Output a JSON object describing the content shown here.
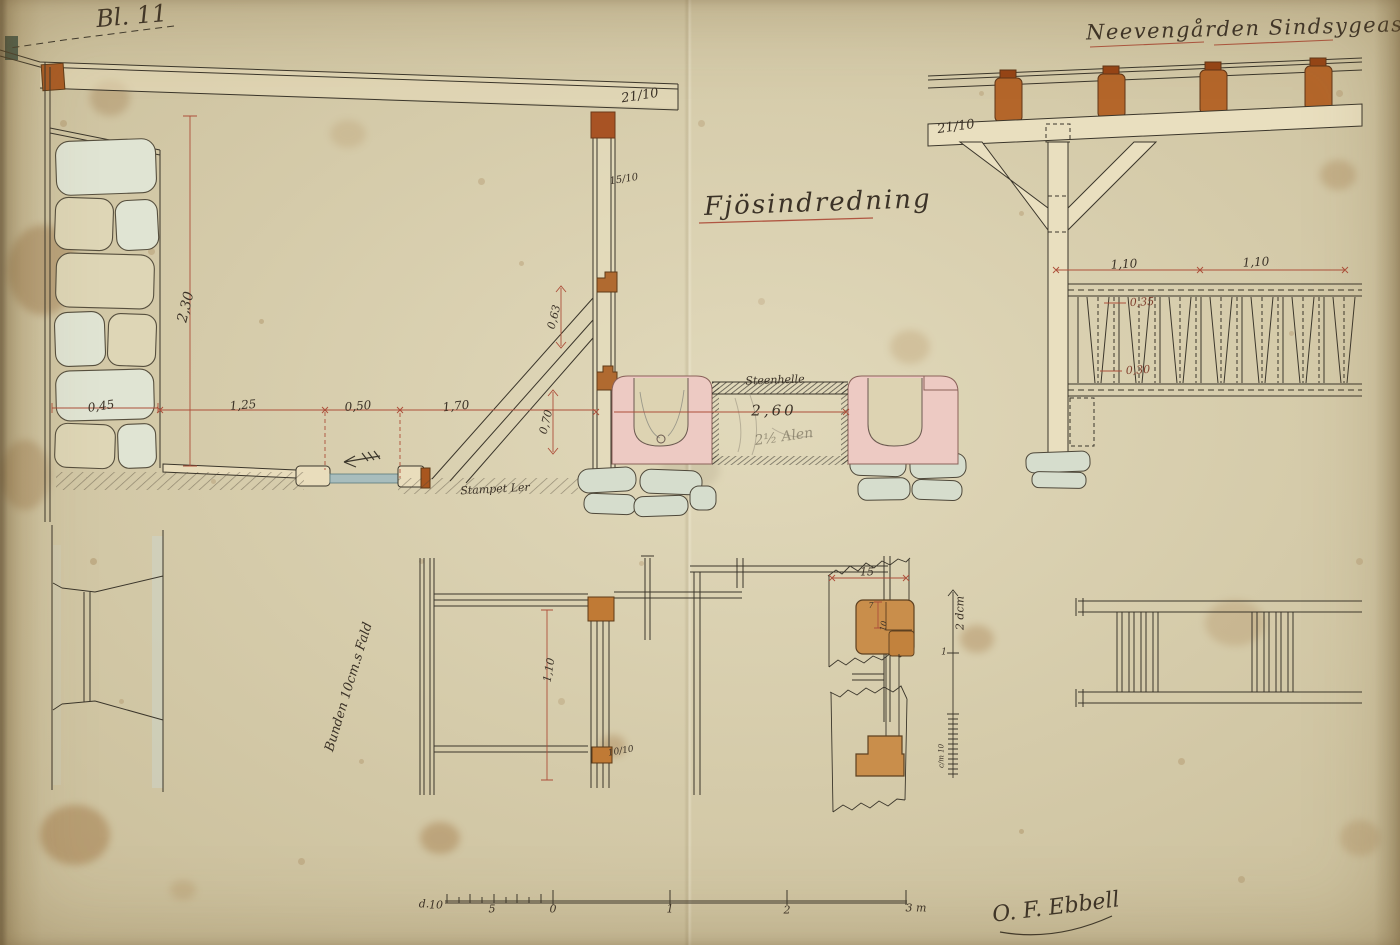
{
  "sheet": {
    "number": "Bl. 11"
  },
  "titles": {
    "project": "Neevengården Sindsygeasyl.",
    "drawing": "Fjösindredning"
  },
  "section": {
    "beam_dim": "21/10",
    "post_dim": "15/10",
    "wall_height": "2,30",
    "wall_thickness": "0,45",
    "span_left": "1,25",
    "span_mid": "0,50",
    "span_right": "1,70",
    "bracket_height": "0,63",
    "trough_height": "0,70",
    "stall_width": "2,60",
    "stall_width_pencil": "2½ Alen",
    "slab_label": "Steenhelle",
    "floor_label": "Stampet Ler"
  },
  "front": {
    "beam_dim": "21/10",
    "bay_left": "1,10",
    "bay_right": "1,10",
    "rack_top_dim": "0,35",
    "rack_bottom_dim": "0,30"
  },
  "plan": {
    "slope_note": "Bunden 10cm.s Fald",
    "bay_height": "1,10",
    "post_dim": "10/10"
  },
  "detail": {
    "width_dim": "15",
    "notch_depth": "7",
    "notch_width": "10",
    "scale_label": "2 dcm",
    "scale_mid_tick": "1",
    "scale_unit": "c/m 10"
  },
  "scale_bar": {
    "prefix": "d.",
    "ticks": [
      "10",
      "5",
      "0",
      "1",
      "2",
      "3 m"
    ]
  },
  "signature": {
    "name": "O. F. Ebbell"
  }
}
